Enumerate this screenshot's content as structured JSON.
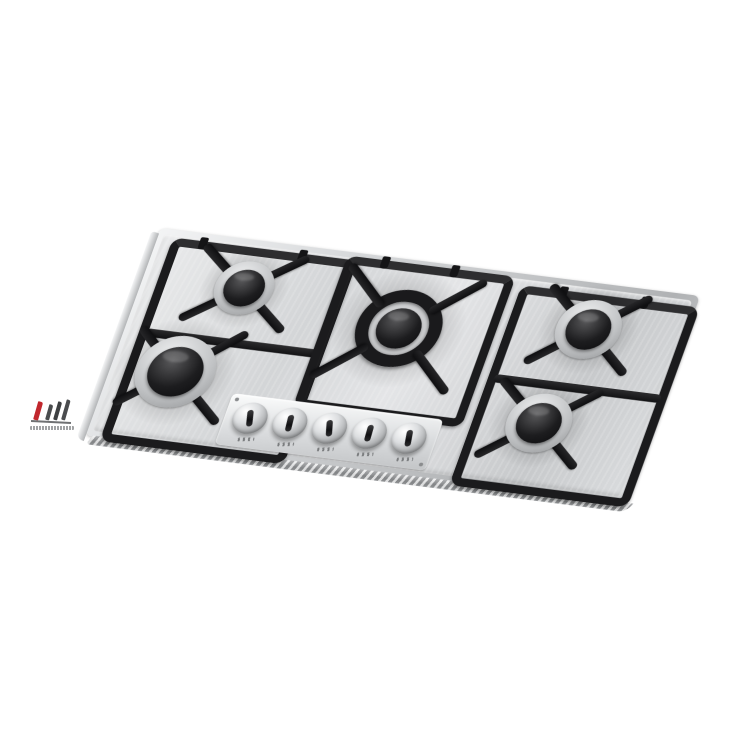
{
  "page": {
    "background_color": "#ffffff",
    "alt_text": "Stainless steel built-in gas hob with five burners, black cast-iron pan supports and five metal control knobs, shown tilted on a white background"
  },
  "colors": {
    "steel_light": "#f3f4f5",
    "steel_mid": "#d3d5d7",
    "steel_dark": "#9fa1a3",
    "grate_black": "#1b1b1d",
    "burner_cap_black": "#1c1c1e",
    "logo_red": "#c1272d",
    "logo_gray": "#47494b"
  },
  "cooktop": {
    "burner_count": 5,
    "knob_count": 5,
    "burners": [
      {
        "id": "burner-left-rear",
        "size": "small"
      },
      {
        "id": "burner-left-front",
        "size": "large"
      },
      {
        "id": "burner-center",
        "size": "extra-large-triple-ring"
      },
      {
        "id": "burner-right-rear",
        "size": "medium"
      },
      {
        "id": "burner-right-front",
        "size": "medium"
      }
    ],
    "knobs": [
      {
        "id": "knob-1"
      },
      {
        "id": "knob-2"
      },
      {
        "id": "knob-3"
      },
      {
        "id": "knob-4"
      },
      {
        "id": "knob-5"
      }
    ]
  },
  "watermark": {
    "caption_legible": false,
    "caption_text": ""
  }
}
